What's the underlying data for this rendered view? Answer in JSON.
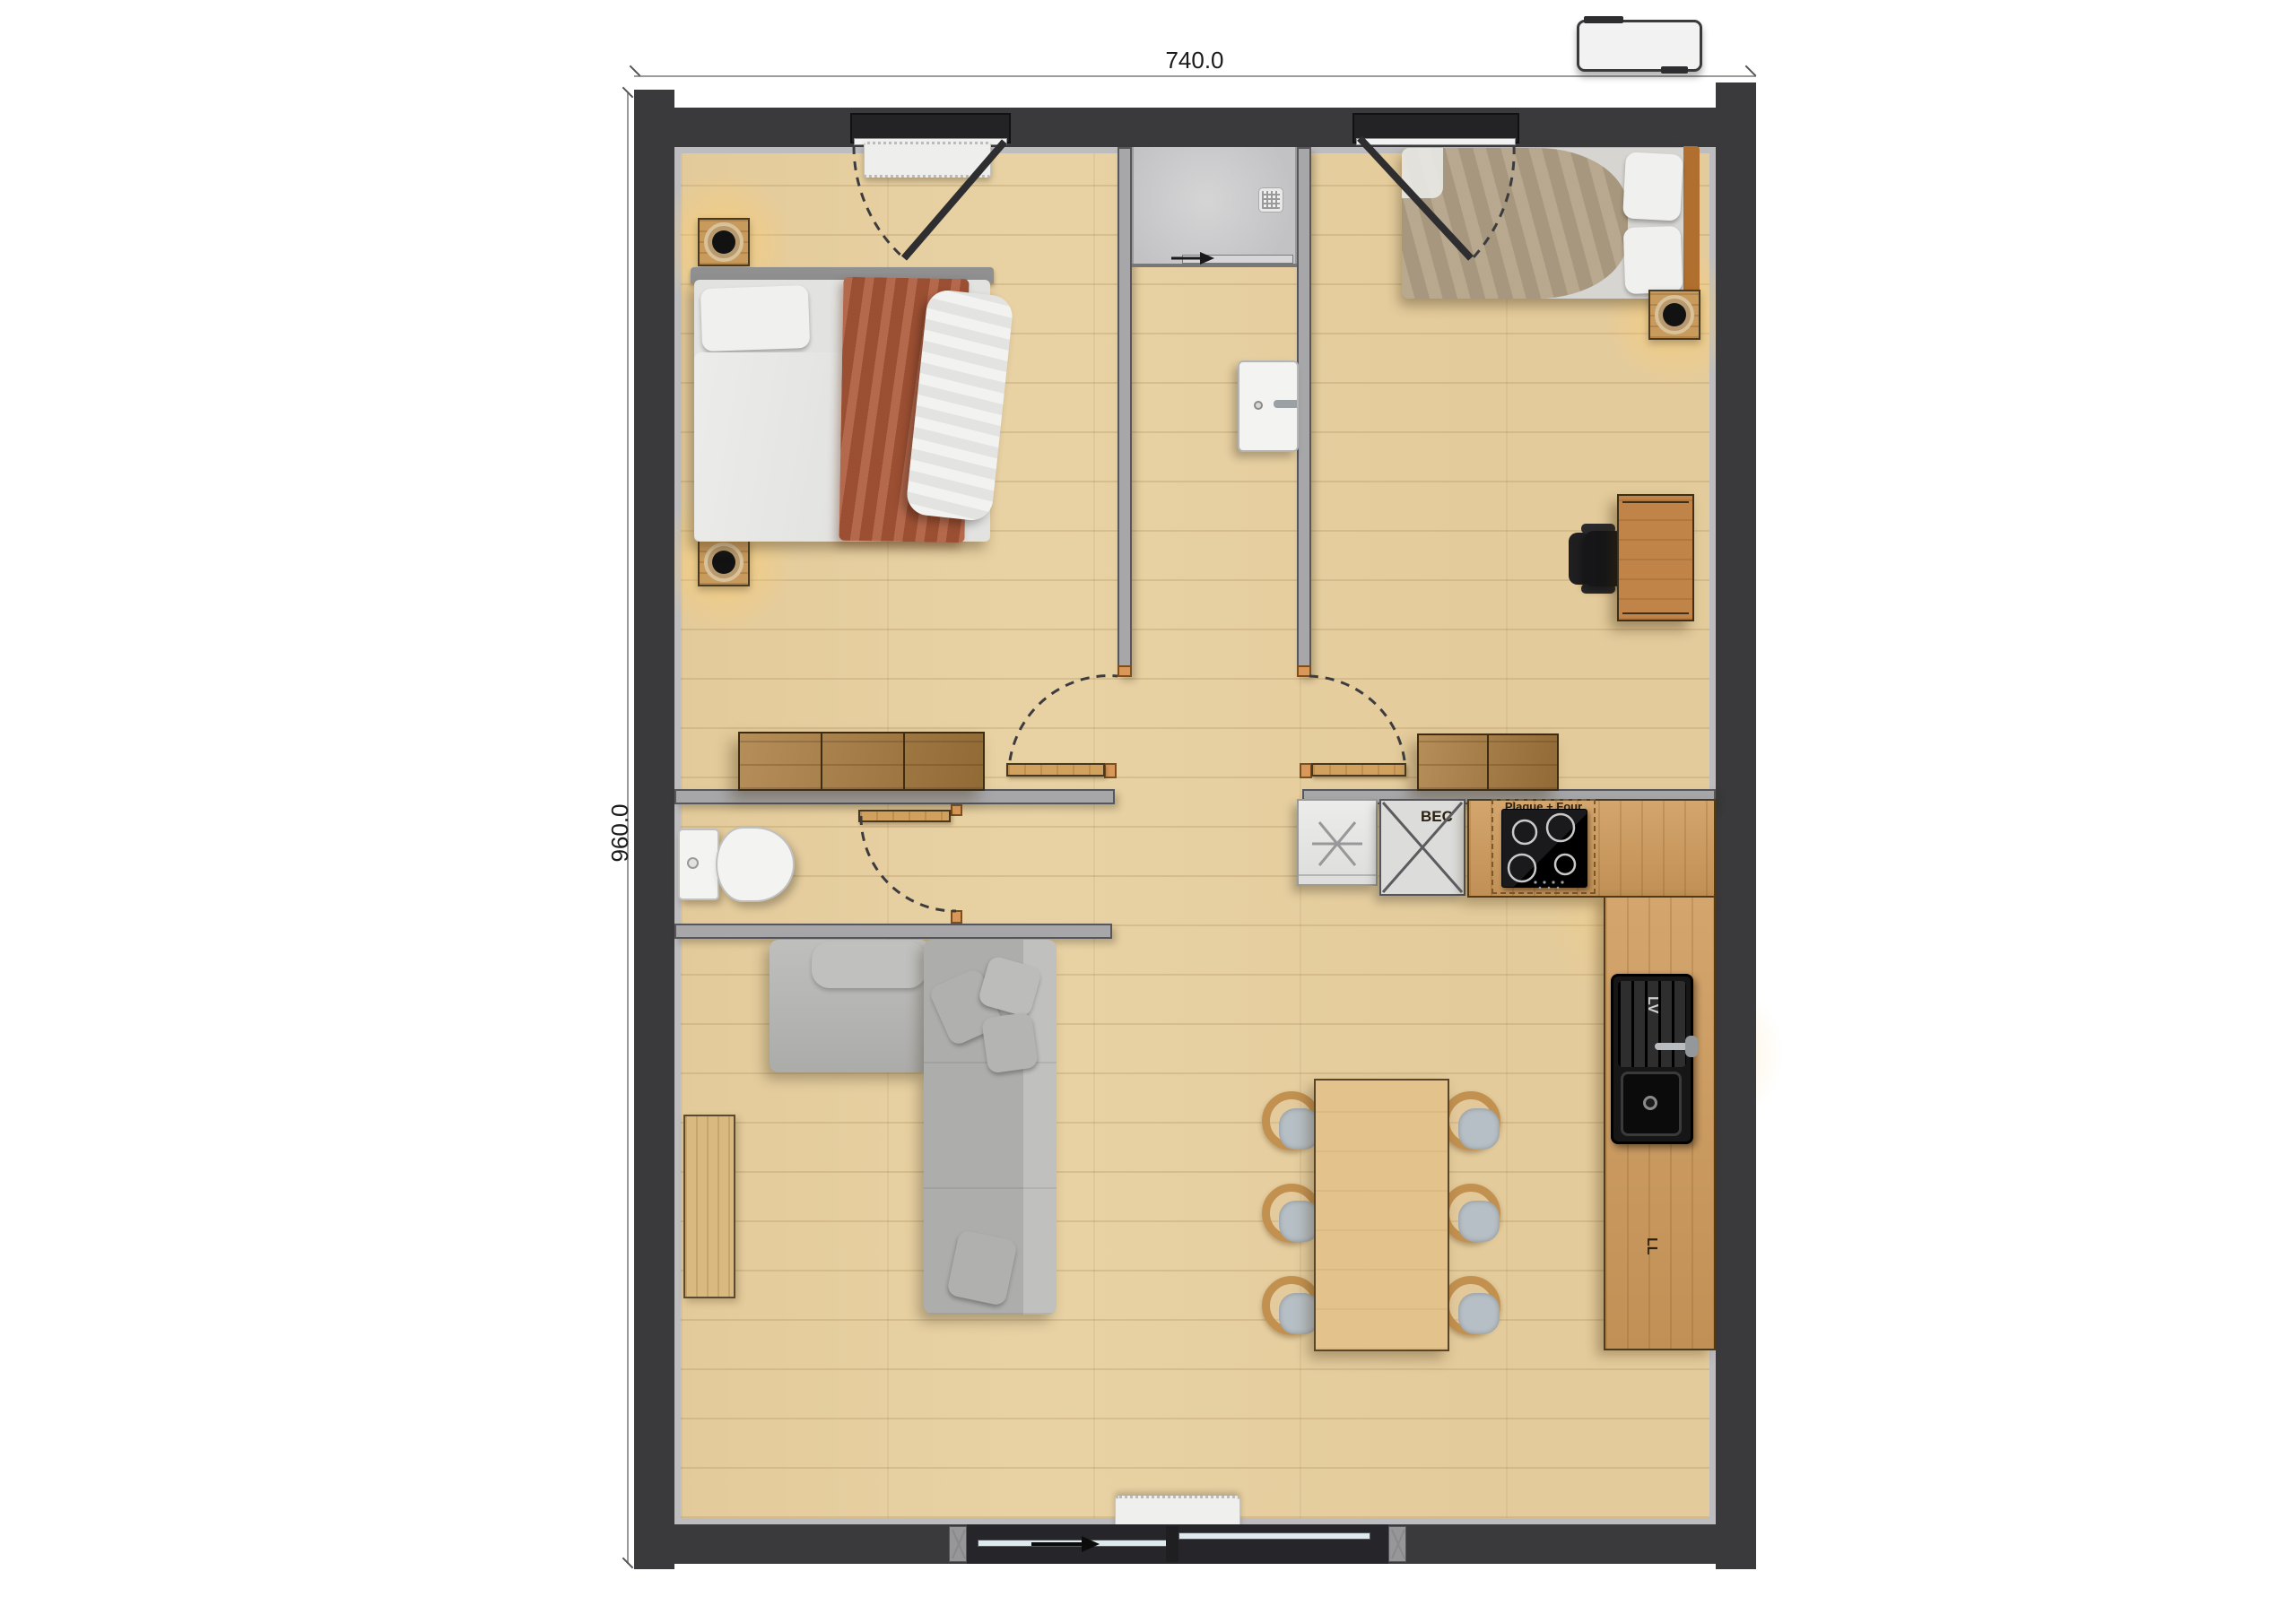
{
  "title": "Two-bedroom apartment floor plan",
  "dimensions": {
    "width_label": "740.0",
    "height_label": "960.0"
  },
  "labels": {
    "kitchen_crossed_unit": "BEC",
    "hob": "Plaque + Four",
    "sink_drainer": "LV",
    "washer": "LL"
  },
  "colors": {
    "wall": "#3a3a3c",
    "iwall": "#a7a7a9",
    "liner": "#bdbdbf",
    "floor": "#e8d2a4",
    "counter": "#cf9b5c",
    "cabinet": "#a97b3e",
    "wood": "#d2a15e",
    "accent": "#d9985a",
    "table": "#e4c28c",
    "seat": "#b6bfc5",
    "sofa": "#b6b6b4",
    "throw": "#ad5838",
    "duvet2": "#b3a287",
    "white-fix": "#f3f3f1",
    "glass": "#dfeaee",
    "glow": "#ffcf7e",
    "black": "#141414",
    "text": "#1a1a1a"
  }
}
